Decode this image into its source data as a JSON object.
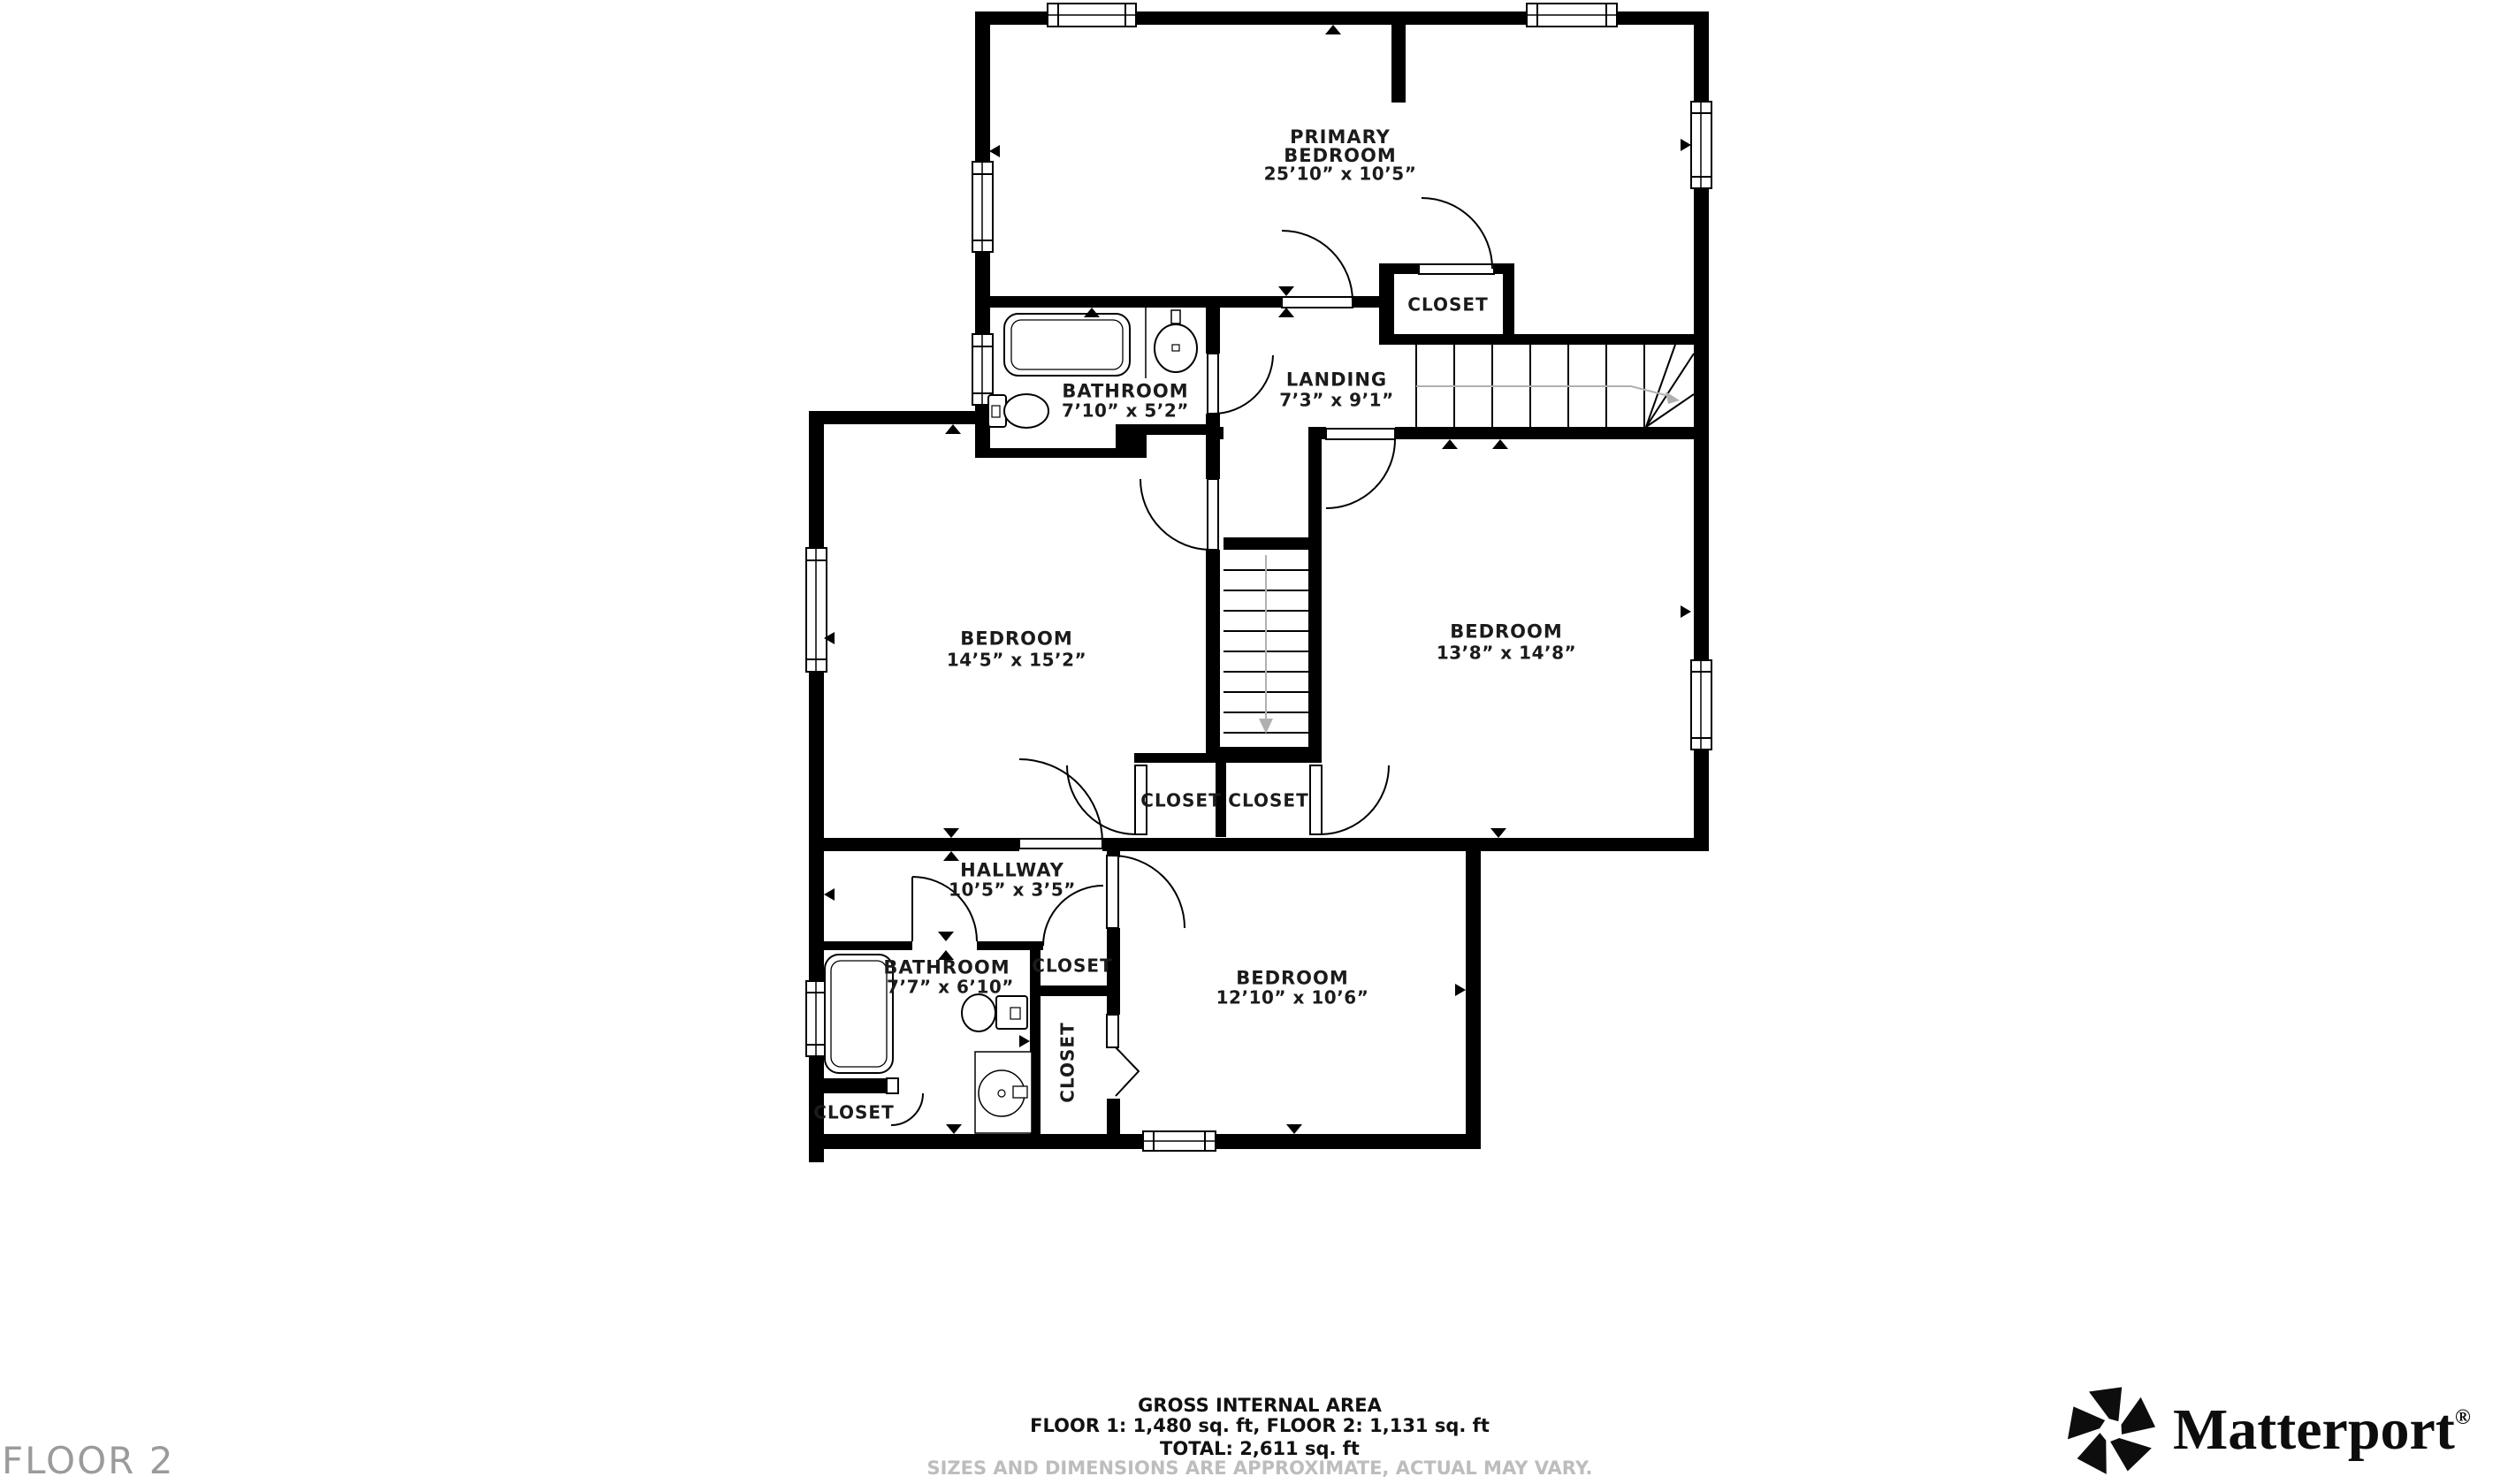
{
  "floor": {
    "tag": "FLOOR 2"
  },
  "rooms": {
    "primary_bedroom": {
      "name": "PRIMARY\nBEDROOM",
      "dims": "25’10” x 10’5”"
    },
    "bathroom_top": {
      "name": "BATHROOM",
      "dims": "7’10” x 5’2”"
    },
    "landing": {
      "name": "LANDING",
      "dims": "7’3” x 9’1”"
    },
    "bedroom_left": {
      "name": "BEDROOM",
      "dims": "14’5” x 15’2”"
    },
    "bedroom_right": {
      "name": "BEDROOM",
      "dims": "13’8” x 14’8”"
    },
    "hallway": {
      "name": "HALLWAY",
      "dims": "10’5” x 3’5”"
    },
    "bathroom_bottom": {
      "name": "BATHROOM",
      "dims": "7’7” x 6’10”"
    },
    "bedroom_bottom": {
      "name": "BEDROOM",
      "dims": "12’10” x 10’6”"
    }
  },
  "closets": {
    "primary": "CLOSET",
    "mid_left": "CLOSET",
    "mid_right": "CLOSET",
    "small": "CLOSET",
    "tall": "CLOSET",
    "bottom_left": "CLOSET"
  },
  "footer": {
    "line1": "GROSS INTERNAL AREA",
    "line2": "FLOOR 1: 1,480 sq. ft, FLOOR 2: 1,131 sq. ft",
    "line3": "TOTAL: 2,611 sq. ft",
    "disclaimer": "SIZES AND DIMENSIONS ARE APPROXIMATE, ACTUAL MAY VARY."
  },
  "logo": {
    "brand": "Matterport",
    "registered": "®"
  },
  "colors": {
    "wall": "#000000",
    "floor_tag": "#9b9b9b",
    "disclaimer": "#bdbdbd",
    "stair_guide": "#b0b0b0"
  }
}
